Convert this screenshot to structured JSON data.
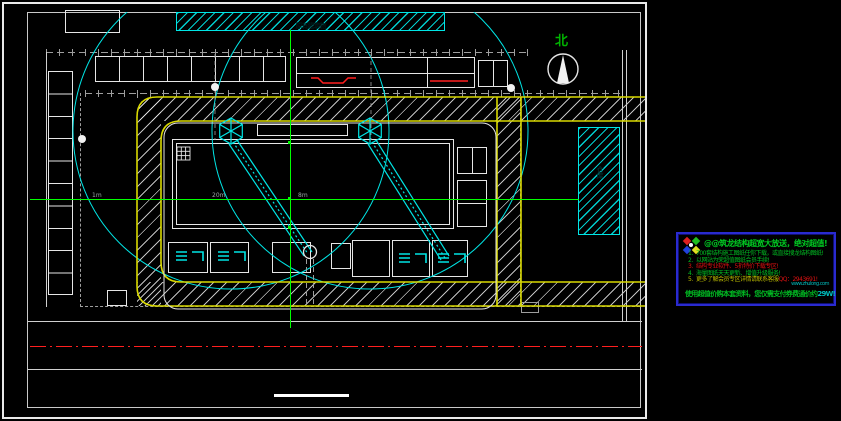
{
  "colors": {
    "cyan": "#00e5e5",
    "yellow": "#d9d900",
    "green": "#00ff00",
    "red": "#ff1f1f",
    "white_line": "#e6e6e6",
    "grey_line": "#9e9e9e",
    "ad_border": "#2a2ad0"
  },
  "drawing": {
    "north_label": "北",
    "top_bar_label": "原有建筑物",
    "storage_label": "仓库",
    "dim_label_1": "1m",
    "dim_label_2": "20m",
    "dim_label_3": "8m"
  },
  "ad": {
    "title": "@@筑龙结构超宽大放送，绝对超值!",
    "items": [
      {
        "num": "1.",
        "text": "700套结构施工图纸任你下载，或直接搜龙结构图纸!",
        "color": "#00bb22"
      },
      {
        "num": "2.",
        "text": "以网站为荣超值图纸会员手续!",
        "color": "#00bb22"
      },
      {
        "num": "3.",
        "text": "结构专业软件、5折特价下载专区!",
        "color": "#dd1111"
      },
      {
        "num": "4.",
        "text": "海量图纸天天更新、增值升级服务!",
        "color": "#00bb22"
      },
      {
        "num": "5.",
        "text": "更多了解会员专区详情请联系客服",
        "color": "#b9b900",
        "highlight": "QQ：2943691!",
        "highlight_color": "#dd1111"
      }
    ],
    "url": "www.zhulong.com",
    "footer": "使用超值价购本套资料，您仅需支付券费通价约",
    "footer_color": "#00bb22",
    "footer_highlight": "29W!",
    "footer_highlight_color": "#00bbbb"
  }
}
